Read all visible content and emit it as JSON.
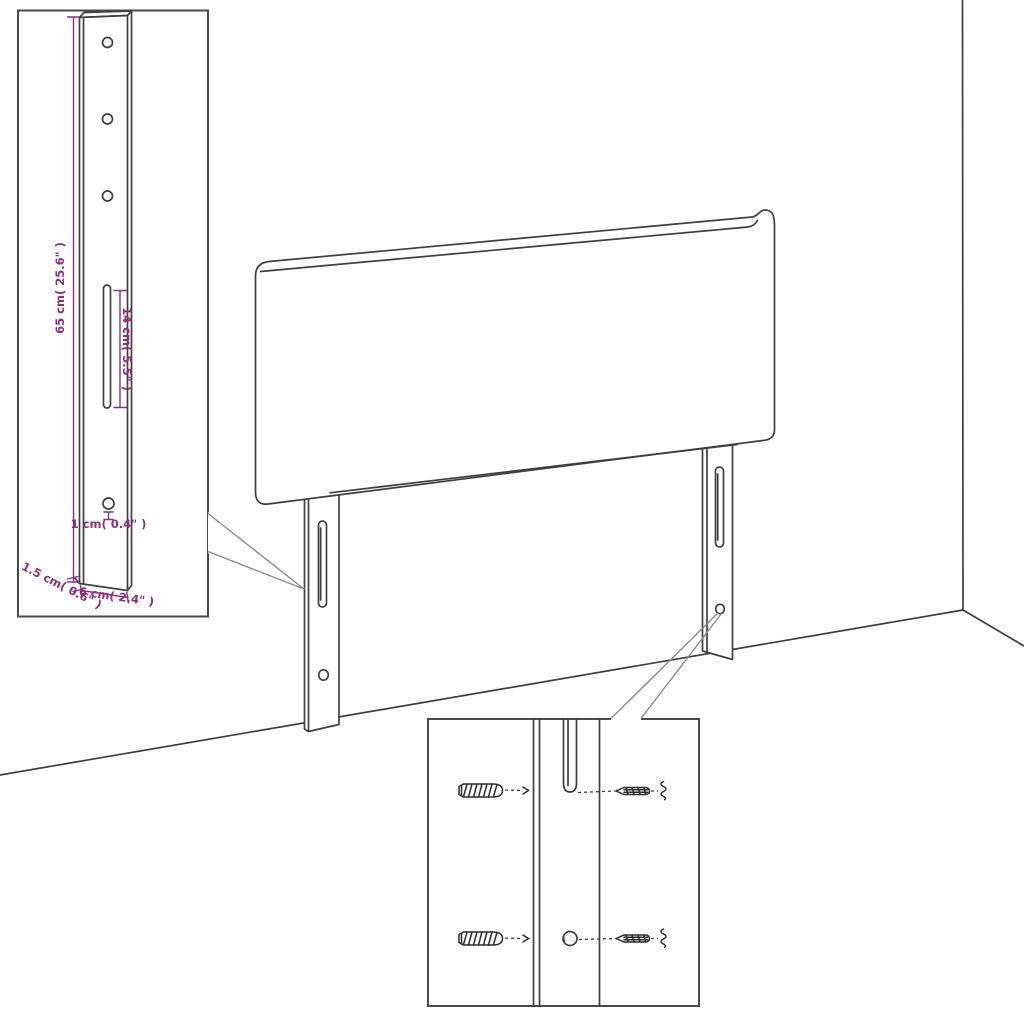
{
  "diagram": {
    "kind": "headboard assembly line diagram with dimension insets",
    "colors": {
      "background": "#ffffff",
      "line": "#3f3f3f",
      "box_border": "#4a4a4a",
      "callout": "#8c8c8c",
      "dimension": "#8e2e80"
    },
    "bracket_inset": {
      "holes_top_count": 3,
      "holes_bottom_count": 1,
      "slot_count": 1,
      "labels": {
        "height": "65 cm( 25.6\" )",
        "slot_length": "14 cm( 5.5\" )",
        "hole_diameter": "1 cm( 0.4\" )",
        "thickness": "1.5 cm( 0.6\" )",
        "width": "6 cm( 2.4\" )"
      }
    },
    "hardware_inset": {
      "wall_plug_count": 2,
      "screw_count": 2
    }
  }
}
